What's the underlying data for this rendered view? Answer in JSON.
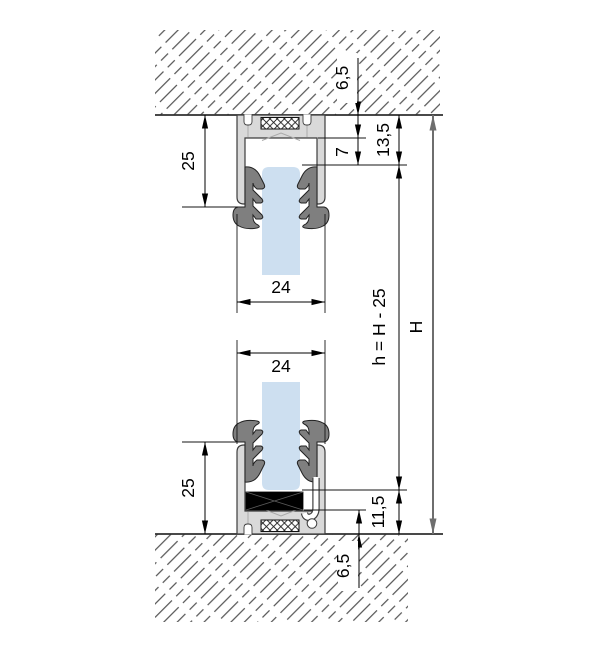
{
  "drawing": {
    "kind": "technical-section",
    "description": "Vertical section of glass partition: top and bottom clamping channel profiles in ceiling and floor",
    "dimensions": {
      "top_recess": "6,5",
      "top_clearance": "7",
      "top_total_inset": "13,5",
      "top_profile_height": "25",
      "top_profile_width": "24",
      "glass_height": "h = H - 25",
      "overall_height": "H",
      "bottom_profile_width": "24",
      "bottom_profile_height": "25",
      "bottom_total_inset": "11,5",
      "bottom_recess": "6,5"
    },
    "colors": {
      "profile": "#d9d9d9",
      "gasket": "#7f7f7f",
      "glass": "#cddff0",
      "setting_block": "#000000",
      "outline": "#3c3c3c",
      "dimension": "#000000",
      "overall_dim": "#6e6e6e"
    }
  }
}
